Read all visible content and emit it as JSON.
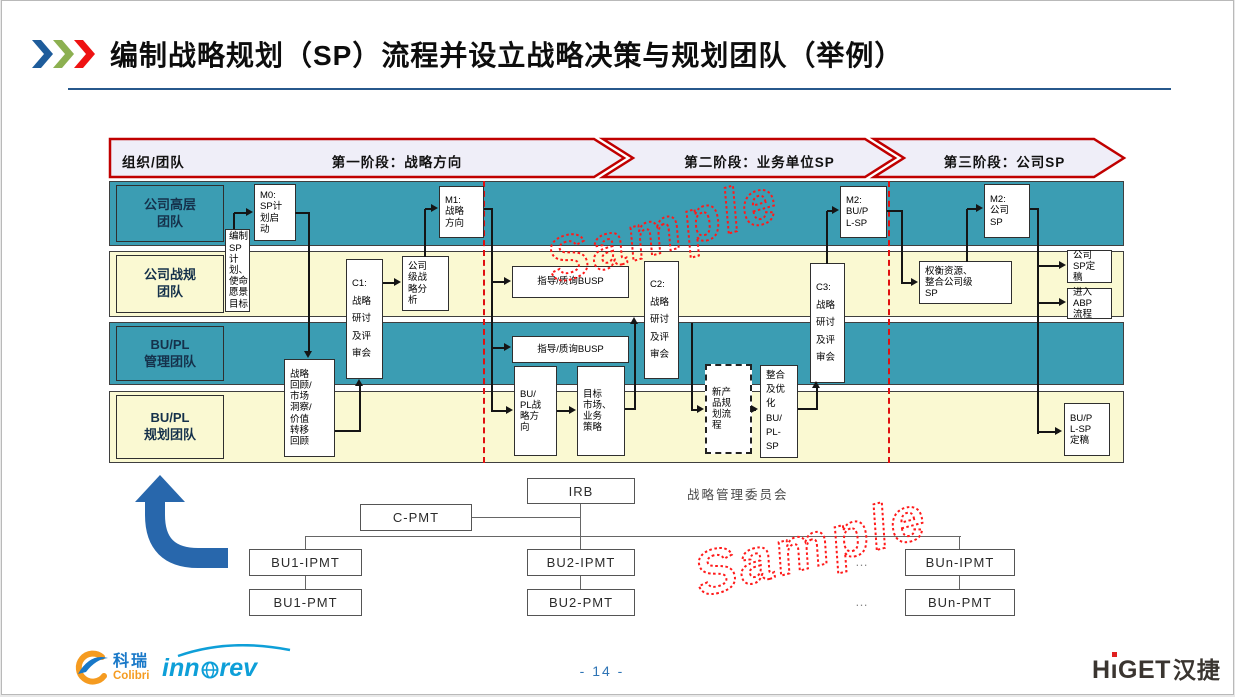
{
  "slide": {
    "title": "编制战略规划（SP）流程并设立战略决策与规划团队（举例）",
    "page_number": "- 14 -",
    "watermark": "Sample"
  },
  "header": {
    "org_label": "组织/团队",
    "stages": [
      "第一阶段：战略方向",
      "第二阶段：业务单位SP",
      "第三阶段：公司SP"
    ]
  },
  "lanes": [
    {
      "id": "exec",
      "label": "公司高层\n团队"
    },
    {
      "id": "corp-plan",
      "label": "公司战规\n团队"
    },
    {
      "id": "bupl-mgmt",
      "label": "BU/PL\n管理团队"
    },
    {
      "id": "bupl-plan",
      "label": "BU/PL\n规划团队"
    }
  ],
  "flow_boxes": [
    {
      "id": "bianzhi",
      "text": "编制\nSP计\n划、\n使命\n愿景\n目标"
    },
    {
      "id": "m0",
      "text": "M0:\nSP计\n划启\n动"
    },
    {
      "id": "huigu",
      "text": "战略\n回顾/\n市场\n洞察/\n价值\n转移\n回顾"
    },
    {
      "id": "c1",
      "text": "C1:\n战略\n研讨\n及评\n审会"
    },
    {
      "id": "fenxi",
      "text": "公司\n级战\n略分\n析"
    },
    {
      "id": "m1",
      "text": "M1:\n战略\n方向"
    },
    {
      "id": "zhidao1",
      "text": "指导/质询BUSP"
    },
    {
      "id": "zhidao2",
      "text": "指导/质询BUSP"
    },
    {
      "id": "fangxiang",
      "text": "BU/\nPL战\n略方\n向"
    },
    {
      "id": "mubiao",
      "text": "目标\n市场、\n业务\n策略"
    },
    {
      "id": "c2",
      "text": "C2:\n战略\n研讨\n及评\n审会"
    },
    {
      "id": "xinchanpin",
      "text": "新产\n品规\n划流\n程",
      "dashed": true
    },
    {
      "id": "zhenghe",
      "text": "整合\n及优\n化\nBU/\nPL-\nSP"
    },
    {
      "id": "c3",
      "text": "C3:\n战略\n研讨\n及评\n审会"
    },
    {
      "id": "m2a",
      "text": "M2:\nBU/P\nL-SP"
    },
    {
      "id": "quanheng",
      "text": "权衡资源、\n整合公司级\nSP"
    },
    {
      "id": "m2b",
      "text": "M2:\n公司\nSP"
    },
    {
      "id": "spding",
      "text": "公司\nSP定\n稿"
    },
    {
      "id": "abp",
      "text": "进入\nABP\n流程"
    },
    {
      "id": "buplding",
      "text": "BU/P\nL-SP\n定稿"
    }
  ],
  "org_chart": {
    "committee_label": "战略管理委员会",
    "ellipsis": "…",
    "boxes": [
      {
        "id": "irb",
        "label": "IRB"
      },
      {
        "id": "cpmt",
        "label": "C-PMT"
      },
      {
        "id": "bu1ipmt",
        "label": "BU1-IPMT"
      },
      {
        "id": "bu1pmt",
        "label": "BU1-PMT"
      },
      {
        "id": "bu2ipmt",
        "label": "BU2-IPMT"
      },
      {
        "id": "bu2pmt",
        "label": "BU2-PMT"
      },
      {
        "id": "bunipmt",
        "label": "BUn-IPMT"
      },
      {
        "id": "bunpmt",
        "label": "BUn-PMT"
      }
    ]
  },
  "footer": {
    "colibri_cn": "科瑞",
    "colibri_en": "Colibri",
    "innorev_left": "inn",
    "innorev_right": "rev",
    "higet_h": "H",
    "higet_rest": "GET",
    "higet_cn": "汉捷"
  },
  "colors": {
    "lane_teal": "#3b9db3",
    "lane_yellow": "#faf9d2",
    "stage_border_red": "#c00000",
    "divider_red": "#e01010",
    "watermark_red": "#ff1a1a",
    "elbow_blue": "#2867ac",
    "accent_blue": "#2e74b5"
  }
}
